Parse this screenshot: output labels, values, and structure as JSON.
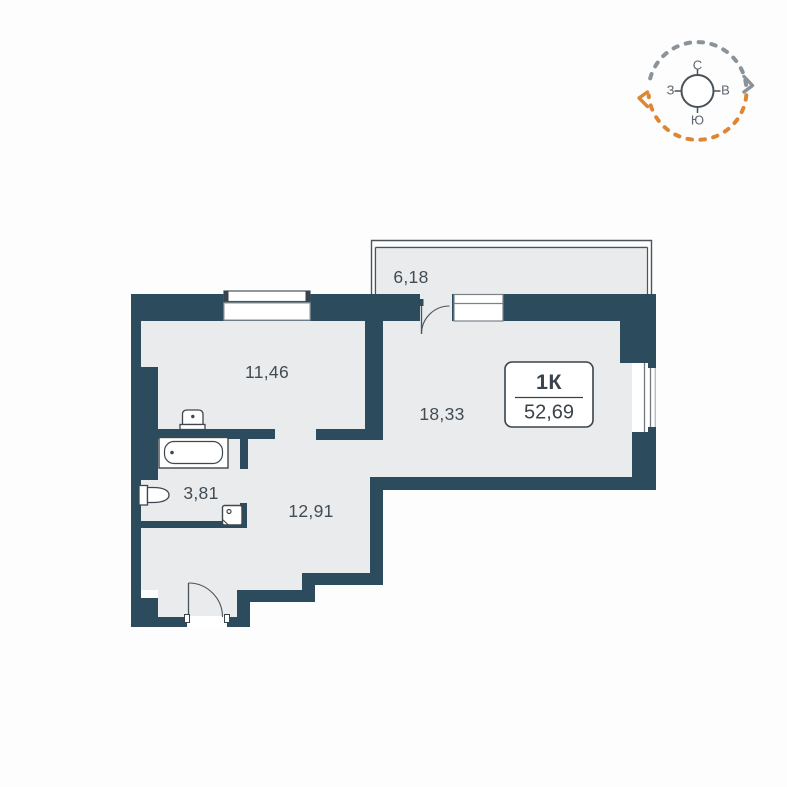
{
  "plan": {
    "apartment_label": {
      "type": "1К",
      "total_area": "52,69"
    },
    "rooms": [
      {
        "name": "balcony",
        "area": "6,18"
      },
      {
        "name": "kitchen-living-room",
        "area": "11,46"
      },
      {
        "name": "living-room",
        "area": "18,33"
      },
      {
        "name": "bathroom",
        "area": "3,81"
      },
      {
        "name": "hallway",
        "area": "12,91"
      }
    ]
  },
  "compass": {
    "north": "С",
    "east": "В",
    "south": "Ю",
    "west": "З"
  },
  "colors": {
    "wall": "#2c4c5d",
    "floor": "#e9ebec",
    "fixture_line": "#3e474e",
    "compass_north_arc": "#8b9298",
    "compass_south_arc": "#df8634"
  }
}
